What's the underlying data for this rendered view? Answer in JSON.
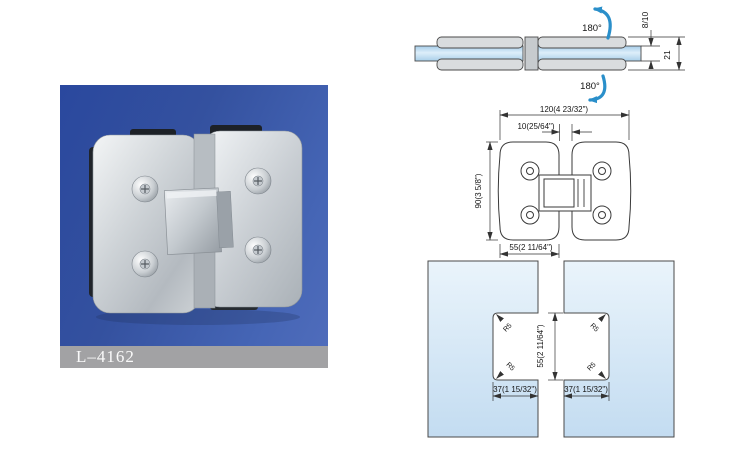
{
  "product_card": {
    "label": "L–4162"
  },
  "side_view": {
    "top_rotation": "180°",
    "bottom_rotation": "180°",
    "glass_thickness": "8/10",
    "overall_thickness": "21"
  },
  "plan_view": {
    "overall_width": "120(4 23/32\")",
    "glass_gap": "10(25/64\")",
    "overall_height": "90(3 5/8\")",
    "plate_width": "55(2 11/64\")"
  },
  "cutout_view": {
    "cutout_height": "55(2 11/64\")",
    "left_cutout_width": "37(1 15/32\")",
    "right_cutout_width": "37(1 15/32\")",
    "radius_top_left": "R5",
    "radius_bottom_left": "R5",
    "radius_top_right": "R5",
    "radius_bottom_right": "R5"
  },
  "colors": {
    "arrow_blue": "#2a8fca",
    "glass_blue": "#bcd9ee",
    "photo_background_blue": "#33509f",
    "label_strip_gray": "#a2a2a4",
    "line_color": "#3a3a3a"
  }
}
